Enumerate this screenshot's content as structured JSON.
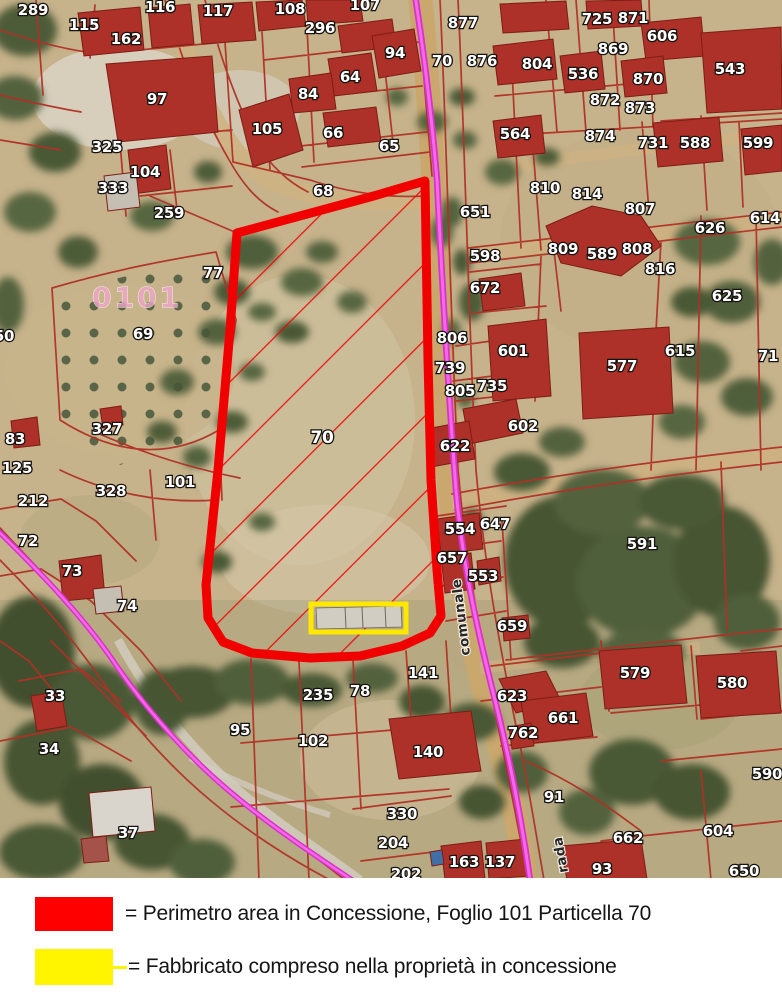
{
  "legend": {
    "items": [
      {
        "swatch_color": "#fe0000",
        "label": "= Perimetro area in Concessione, Foglio 101 Particella 70"
      },
      {
        "swatch_color": "#fff500",
        "label": "= Fabbricato compreso nella proprietà in concessione"
      }
    ]
  },
  "map": {
    "sheet_label": "0101",
    "highlight": {
      "perimeter_color": "#f00000",
      "hatch_color": "#f00000",
      "building_box_color": "#ffe800",
      "road_color": "#d633c8",
      "road_core_color": "#f768e8",
      "parcel_line_color": "#b03026"
    },
    "road_labels": [
      {
        "text": "comunale",
        "x": 470,
        "y": 655,
        "rotate": -97
      },
      {
        "text": "rada",
        "x": 568,
        "y": 872,
        "rotate": -100
      }
    ],
    "parcel_labels": [
      [
        "289",
        33,
        10
      ],
      [
        "115",
        84,
        25
      ],
      [
        "162",
        126,
        39
      ],
      [
        "116",
        160,
        7
      ],
      [
        "117",
        218,
        11
      ],
      [
        "97",
        157,
        99
      ],
      [
        "325",
        107,
        147
      ],
      [
        "104",
        145,
        172
      ],
      [
        "333",
        113,
        188
      ],
      [
        "259",
        169,
        213
      ],
      [
        "108",
        290,
        9
      ],
      [
        "296",
        320,
        28
      ],
      [
        "107",
        365,
        5
      ],
      [
        "94",
        395,
        53
      ],
      [
        "64",
        350,
        77
      ],
      [
        "84",
        308,
        94
      ],
      [
        "105",
        267,
        129
      ],
      [
        "66",
        333,
        133
      ],
      [
        "65",
        389,
        146
      ],
      [
        "68",
        323,
        191
      ],
      [
        "877",
        463,
        23
      ],
      [
        "70",
        442,
        61
      ],
      [
        "876",
        482,
        61
      ],
      [
        "725",
        597,
        19
      ],
      [
        "871",
        633,
        18
      ],
      [
        "606",
        662,
        36
      ],
      [
        "869",
        613,
        49
      ],
      [
        "804",
        537,
        64
      ],
      [
        "536",
        583,
        74
      ],
      [
        "870",
        648,
        79
      ],
      [
        "543",
        730,
        69
      ],
      [
        "872",
        605,
        100
      ],
      [
        "873",
        640,
        108
      ],
      [
        "564",
        515,
        134
      ],
      [
        "874",
        600,
        136
      ],
      [
        "731",
        653,
        143
      ],
      [
        "588",
        695,
        143
      ],
      [
        "599",
        758,
        143
      ],
      [
        "810",
        545,
        188
      ],
      [
        "814",
        587,
        194
      ],
      [
        "807",
        640,
        209
      ],
      [
        "651",
        475,
        212
      ],
      [
        "626",
        710,
        228
      ],
      [
        "614",
        765,
        218
      ],
      [
        "598",
        485,
        256
      ],
      [
        "809",
        563,
        249
      ],
      [
        "589",
        602,
        254
      ],
      [
        "808",
        637,
        249
      ],
      [
        "816",
        660,
        269
      ],
      [
        "672",
        485,
        288
      ],
      [
        "625",
        727,
        296
      ],
      [
        "806",
        452,
        338
      ],
      [
        "601",
        513,
        351
      ],
      [
        "739",
        450,
        368
      ],
      [
        "615",
        680,
        351
      ],
      [
        "71",
        768,
        356
      ],
      [
        "577",
        622,
        366
      ],
      [
        "805",
        460,
        391
      ],
      [
        "735",
        492,
        386
      ],
      [
        "602",
        523,
        426
      ],
      [
        "622",
        455,
        446
      ],
      [
        "77",
        213,
        273
      ],
      [
        "69",
        143,
        334
      ],
      [
        "50",
        4,
        336
      ],
      [
        "83",
        15,
        439
      ],
      [
        "327",
        107,
        429
      ],
      [
        "125",
        17,
        468
      ],
      [
        "328",
        111,
        491
      ],
      [
        "101",
        180,
        482
      ],
      [
        "212",
        33,
        501
      ],
      [
        "72",
        28,
        541
      ],
      [
        "73",
        72,
        571
      ],
      [
        "74",
        127,
        606
      ],
      [
        "33",
        55,
        696
      ],
      [
        "34",
        49,
        749
      ],
      [
        "37",
        128,
        833
      ],
      [
        "95",
        240,
        730
      ],
      [
        "657",
        452,
        558
      ],
      [
        "553",
        483,
        576
      ],
      [
        "554",
        460,
        529
      ],
      [
        "647",
        495,
        524
      ],
      [
        "659",
        512,
        626
      ],
      [
        "591",
        642,
        544
      ],
      [
        "141",
        423,
        673
      ],
      [
        "78",
        360,
        691
      ],
      [
        "235",
        318,
        695
      ],
      [
        "102",
        313,
        741
      ],
      [
        "140",
        428,
        752
      ],
      [
        "330",
        402,
        814
      ],
      [
        "204",
        393,
        843
      ],
      [
        "163",
        464,
        862
      ],
      [
        "137",
        500,
        862
      ],
      [
        "202",
        406,
        874
      ],
      [
        "579",
        635,
        673
      ],
      [
        "580",
        732,
        683
      ],
      [
        "623",
        512,
        696
      ],
      [
        "661",
        563,
        718
      ],
      [
        "762",
        523,
        733
      ],
      [
        "91",
        554,
        797
      ],
      [
        "590",
        767,
        774
      ],
      [
        "662",
        628,
        838
      ],
      [
        "604",
        718,
        831
      ],
      [
        "93",
        602,
        869
      ],
      [
        "650",
        744,
        871
      ],
      [
        "70",
        322,
        438,
        "big"
      ]
    ]
  }
}
